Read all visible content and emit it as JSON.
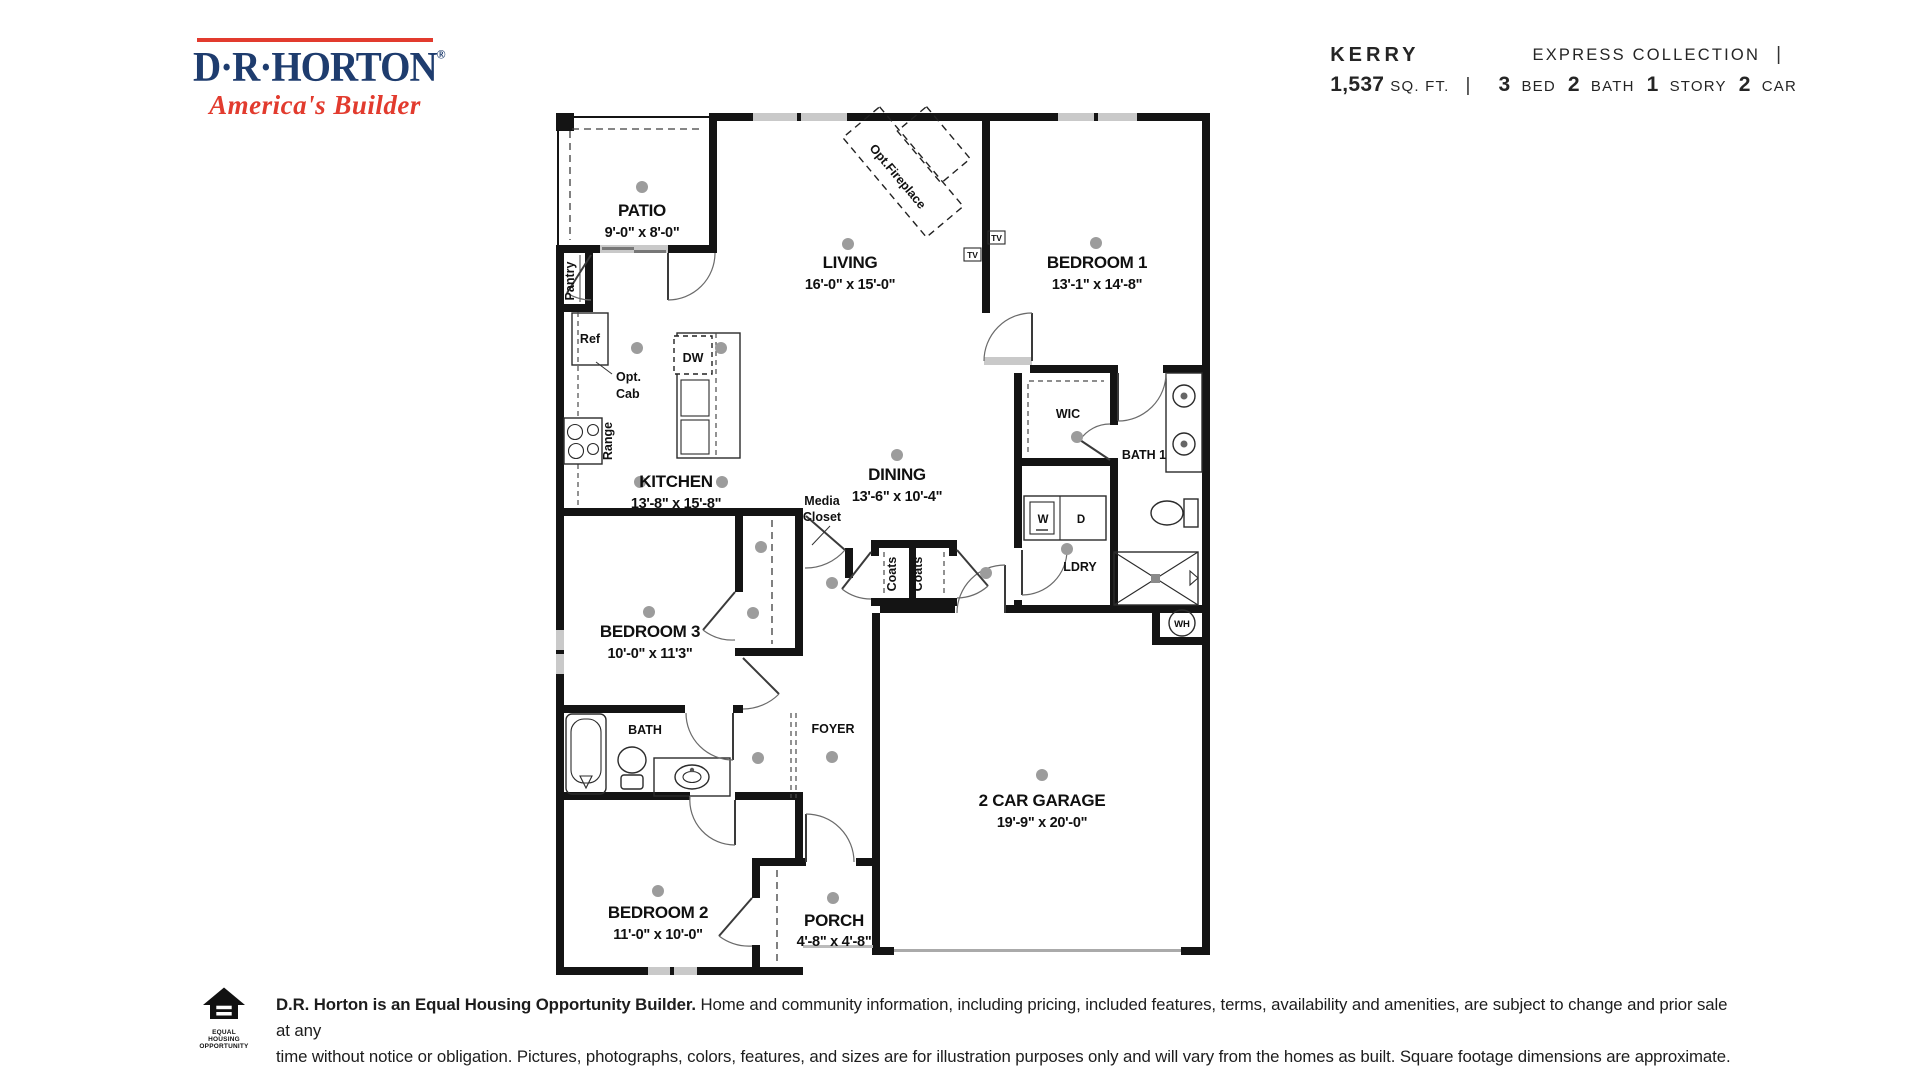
{
  "logo": {
    "brand": "D·R·HORTON",
    "registered": "®",
    "tagline": "America's Builder"
  },
  "header": {
    "collection": "EXPRESS COLLECTION",
    "divider": "|",
    "plan_name": "KERRY",
    "sqft_value": "1,537",
    "sqft_label": "SQ. FT.",
    "specs": [
      {
        "value": "3",
        "label": "BED"
      },
      {
        "value": "2",
        "label": "BATH"
      },
      {
        "value": "1",
        "label": "STORY"
      },
      {
        "value": "2",
        "label": "CAR"
      }
    ]
  },
  "floorplan": {
    "rooms": [
      {
        "name": "PATIO",
        "dims": "9'-0\" x 8'-0\""
      },
      {
        "name": "LIVING",
        "dims": "16'-0\" x 15'-0\""
      },
      {
        "name": "BEDROOM 1",
        "dims": "13'-1\" x 14'-8\""
      },
      {
        "name": "KITCHEN",
        "dims": "13'-8\" x 15'-8\""
      },
      {
        "name": "DINING",
        "dims": "13'-6\" x 10'-4\""
      },
      {
        "name": "BEDROOM 3",
        "dims": "10'-0\" x 11'3\""
      },
      {
        "name": "2 CAR GARAGE",
        "dims": "19'-9\" x 20'-0\""
      },
      {
        "name": "BEDROOM 2",
        "dims": "11'-0\" x 10'-0\""
      },
      {
        "name": "PORCH",
        "dims": "4'-8\" x 4'-8\""
      }
    ],
    "labels": {
      "wic": "WIC",
      "bath1": "BATH 1",
      "bath": "BATH",
      "ldry": "LDRY",
      "foyer": "FOYER",
      "pantry": "Pantry",
      "ref": "Ref",
      "opt1": "Opt.",
      "opt2": "Cab",
      "range": "Range",
      "dw": "DW",
      "washer": "W",
      "dryer": "D",
      "coats": "Coats",
      "media1": "Media",
      "media2": "Closet",
      "fireplace": "Opt.Fireplace",
      "tv": "TV",
      "wh": "WH"
    }
  },
  "footer": {
    "eho1": "EQUAL HOUSING",
    "eho2": "OPPORTUNITY",
    "disclaimer_bold": "D.R. Horton is an Equal Housing Opportunity Builder.",
    "disclaimer_rest": " Home and community information, including pricing, included features, terms, availability and amenities, are subject to change and prior sale at any",
    "disclaimer_line2": "time without notice or obligation. Pictures, photographs, colors, features, and sizes are for illustration purposes only and will vary from the homes as built. Square footage dimensions are approximate."
  }
}
